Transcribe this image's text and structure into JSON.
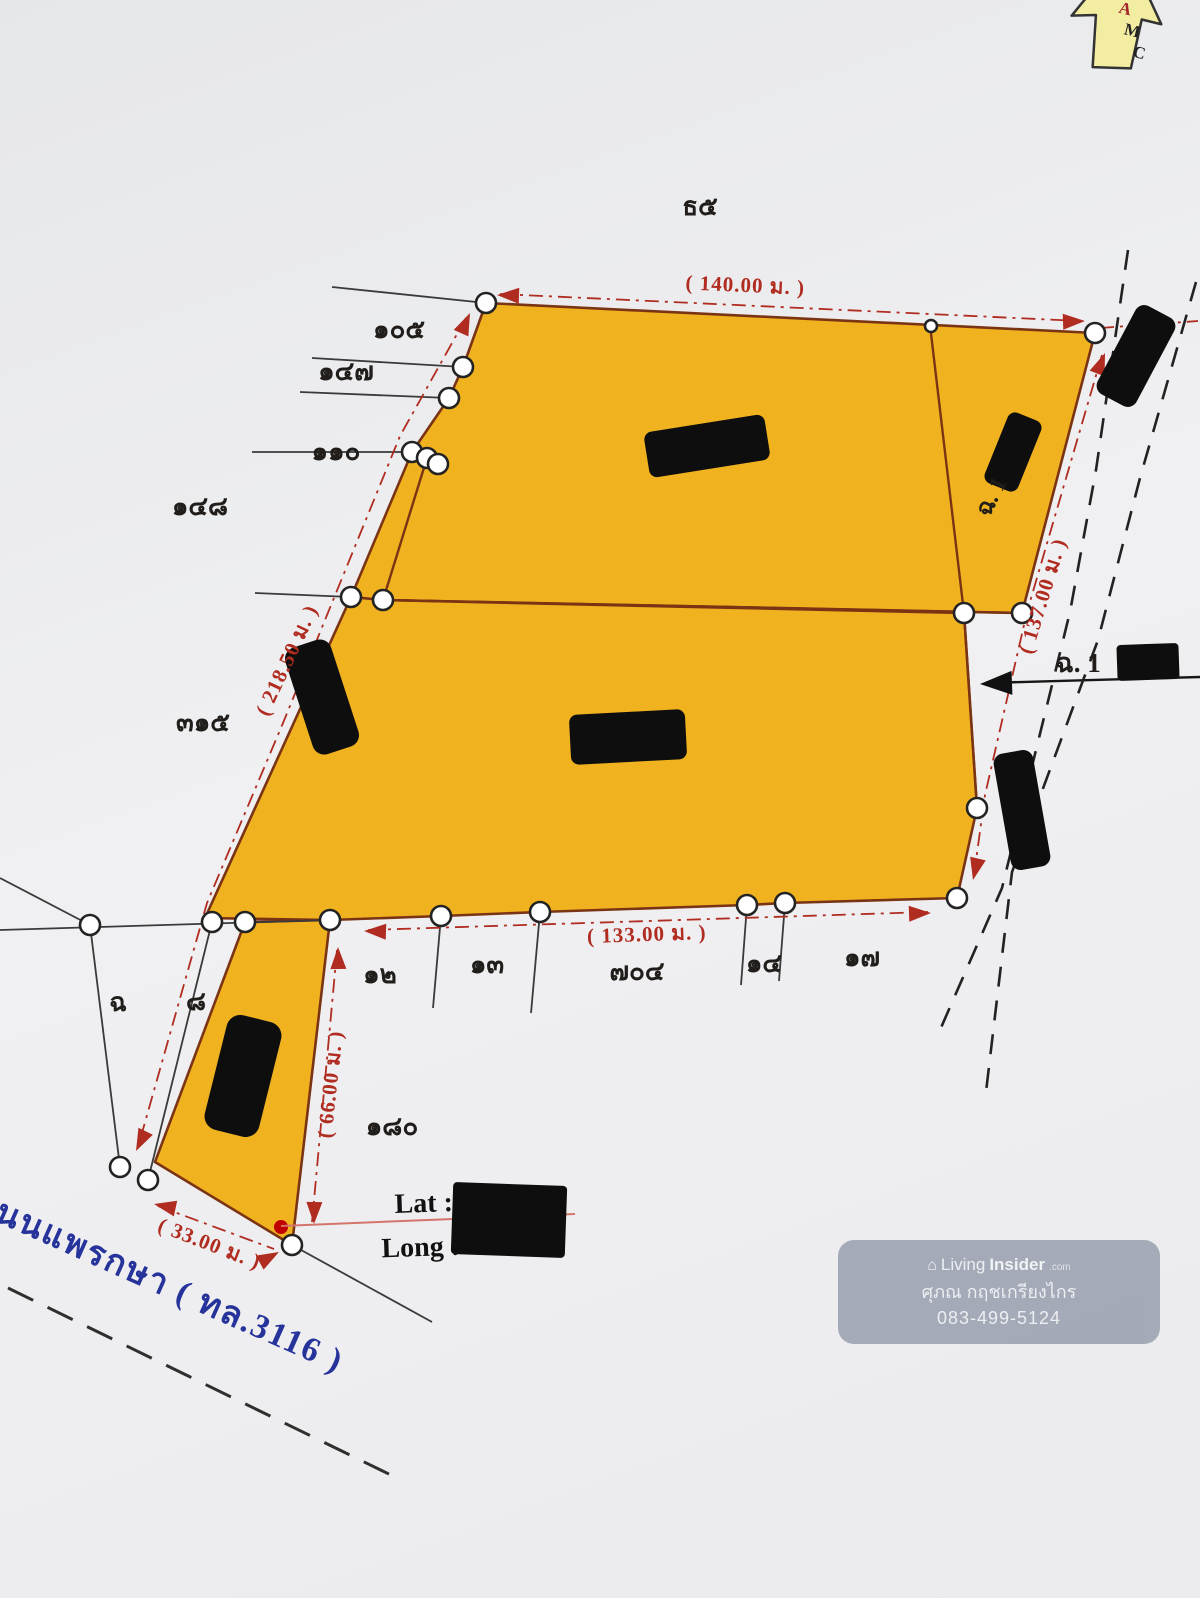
{
  "colors": {
    "parcel_fill": "#F1B220",
    "parcel_stroke": "#7a3414",
    "dim_red": "#b02c20",
    "road_blue": "#26339b",
    "watermark_bg": "#9FA5B4",
    "redaction": "#0e0e0e"
  },
  "logo": {
    "letters": [
      "A",
      "M",
      "C"
    ]
  },
  "map_texts": [
    {
      "name": "plot-no-top",
      "text": "ธ๕",
      "x": 700,
      "y": 215,
      "rot": 0,
      "size": 26,
      "cls": "tk"
    },
    {
      "name": "vertex-105",
      "text": "๑๐๕",
      "x": 399,
      "y": 338,
      "rot": 0,
      "size": 26,
      "cls": "tk"
    },
    {
      "name": "vertex-147",
      "text": "๑๔๗",
      "x": 346,
      "y": 380,
      "rot": 0,
      "size": 26,
      "cls": "tk"
    },
    {
      "name": "vertex-110",
      "text": "๑๑๐",
      "x": 336,
      "y": 460,
      "rot": 0,
      "size": 26,
      "cls": "tk"
    },
    {
      "name": "vertex-148",
      "text": "๑๔๘",
      "x": 200,
      "y": 515,
      "rot": 0,
      "size": 26,
      "cls": "tk"
    },
    {
      "name": "vertex-315",
      "text": "๓๑๕",
      "x": 203,
      "y": 731,
      "rot": 0,
      "size": 26,
      "cls": "tk"
    },
    {
      "name": "vertex-cho",
      "text": "ฉ",
      "x": 118,
      "y": 1011,
      "rot": 0,
      "size": 26,
      "cls": "tk"
    },
    {
      "name": "vertex-8",
      "text": "๘",
      "x": 196,
      "y": 1010,
      "rot": 0,
      "size": 26,
      "cls": "tk"
    },
    {
      "name": "vertex-12",
      "text": "๑๒",
      "x": 380,
      "y": 983,
      "rot": 0,
      "size": 26,
      "cls": "tk"
    },
    {
      "name": "vertex-13",
      "text": "๑๓",
      "x": 487,
      "y": 973,
      "rot": 0,
      "size": 26,
      "cls": "tk"
    },
    {
      "name": "vertex-704",
      "text": "๗๐๔",
      "x": 637,
      "y": 980,
      "rot": 0,
      "size": 26,
      "cls": "tk"
    },
    {
      "name": "vertex-14",
      "text": "๑๔",
      "x": 764,
      "y": 972,
      "rot": 0,
      "size": 26,
      "cls": "tk"
    },
    {
      "name": "vertex-17",
      "text": "๑๗",
      "x": 862,
      "y": 966,
      "rot": 0,
      "size": 26,
      "cls": "tk"
    },
    {
      "name": "vertex-180",
      "text": "๑๘๐",
      "x": 392,
      "y": 1135,
      "rot": 0,
      "size": 26,
      "cls": "tk"
    },
    {
      "name": "dimension-140m",
      "text": "( 140.00 ม. )",
      "x": 745,
      "y": 292,
      "rot": 2.5,
      "size": 21,
      "cls": "dim"
    },
    {
      "name": "dimension-218-50m",
      "text": "( 218.50 ม. )",
      "x": 293,
      "y": 663,
      "rot": -65,
      "size": 21,
      "cls": "dim"
    },
    {
      "name": "dimension-137m",
      "text": "( 137.00 ม. )",
      "x": 1049,
      "y": 598,
      "rot": -73,
      "size": 21,
      "cls": "dim"
    },
    {
      "name": "dimension-133m",
      "text": "( 133.00 ม. )",
      "x": 647,
      "y": 941,
      "rot": -2,
      "size": 21,
      "cls": "dim"
    },
    {
      "name": "dimension-66m",
      "text": "( 66.00 ม. )",
      "x": 337,
      "y": 1085,
      "rot": -84,
      "size": 21,
      "cls": "dim"
    },
    {
      "name": "dimension-33m",
      "text": "( 33.00 ม. )",
      "x": 207,
      "y": 1250,
      "rot": 21,
      "size": 21,
      "cls": "dim"
    },
    {
      "name": "parcel-ref-right",
      "text": "ฉ. 1",
      "x": 1078,
      "y": 672,
      "rot": 0,
      "size": 27,
      "cls": "tk"
    },
    {
      "name": "parcel-ref-upper",
      "text": "ฉ. 1",
      "x": 998,
      "y": 500,
      "rot": -63,
      "size": 24,
      "cls": "tk"
    },
    {
      "name": "lat-label",
      "text": "Lat  :",
      "x": 424,
      "y": 1212,
      "rot": -2,
      "size": 28,
      "cls": "latin"
    },
    {
      "name": "long-label",
      "text": "Long  :",
      "x": 421,
      "y": 1256,
      "rot": -2,
      "size": 28,
      "cls": "latin"
    },
    {
      "name": "road-name",
      "text": "ถนนแพรกษา ( ทล.3116 )",
      "x": 155,
      "y": 1292,
      "rot": 24,
      "size": 34,
      "cls": "road"
    }
  ],
  "watermark": {
    "brand_living": "Living",
    "brand_insider": "Insider",
    "brand_tld": ".com",
    "agent_name": "ศุภณ กฤชเกรียงไกร",
    "phone": "083-499-5124"
  }
}
